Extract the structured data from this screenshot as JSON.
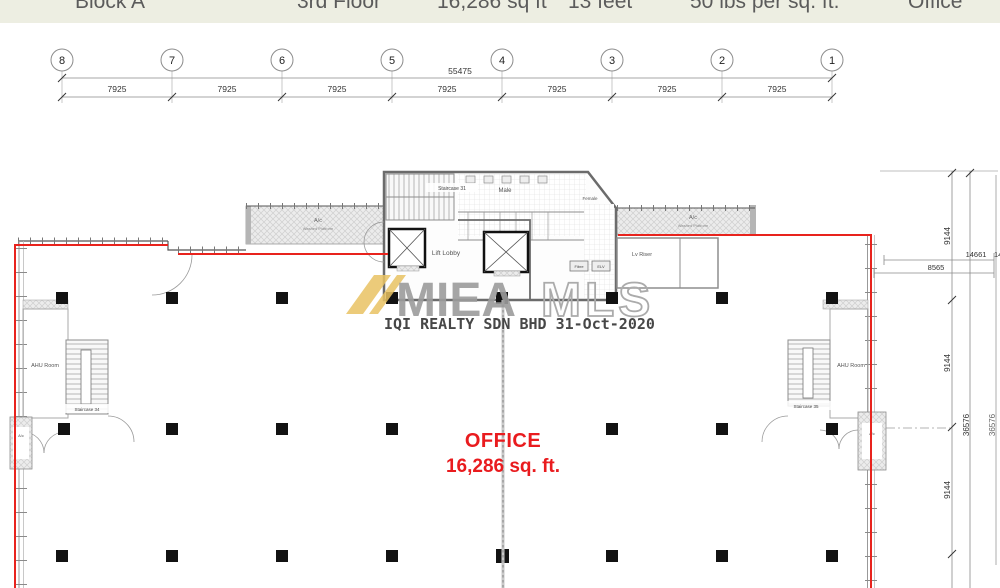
{
  "header": {
    "items": [
      "Block A",
      "3rd Floor",
      "16,286 sq ft",
      "13 feet",
      "50 lbs per sq. ft.",
      "Office"
    ]
  },
  "grid": {
    "cols": [
      "8",
      "7",
      "6",
      "5",
      "4",
      "3",
      "2",
      "1"
    ],
    "total": "55475",
    "bays": [
      "7925",
      "7925",
      "7925",
      "7925",
      "7925",
      "7925",
      "7925"
    ]
  },
  "dims_right": {
    "bays": [
      "9144",
      "9144",
      "9144"
    ],
    "total": "36576",
    "d_14661": "14661",
    "d_8565": "8565",
    "edge_total": "36576",
    "edge_partial": "14661"
  },
  "core": {
    "staircase_top": "Staircase 31",
    "male": "Male",
    "female": "Female",
    "lift_lobby": "Lift Lobby",
    "fibre": "Fibre",
    "elv": "ELV",
    "lv_riser": "Lv Riser"
  },
  "left_wing": {
    "ahu": "AHU Room",
    "staircase": "Staircase 34",
    "ac_room": "A/c"
  },
  "right_wing": {
    "ahu": "AHU Room",
    "staircase": "Staircase 35",
    "ac_room": "A/c"
  },
  "platforms": {
    "left_l1": "A/c",
    "left_l2": "Washed Platform",
    "right_l1": "A/c",
    "right_l2": "Washed Platform"
  },
  "watermark": {
    "brand_solid": "MIEA",
    "brand_outline": "MLS",
    "agency_line": "IQI REALTY SDN BHD 31-Oct-2020"
  },
  "office_label": {
    "title": "OFFICE",
    "area": "16,286 sq. ft."
  },
  "colors": {
    "boundary_red": "#e8231d",
    "office_red": "#e91b1e",
    "watermark_gold": "#e9c363",
    "watermark_gray": "#9c9c9c",
    "header_bg": "#edeee2"
  }
}
